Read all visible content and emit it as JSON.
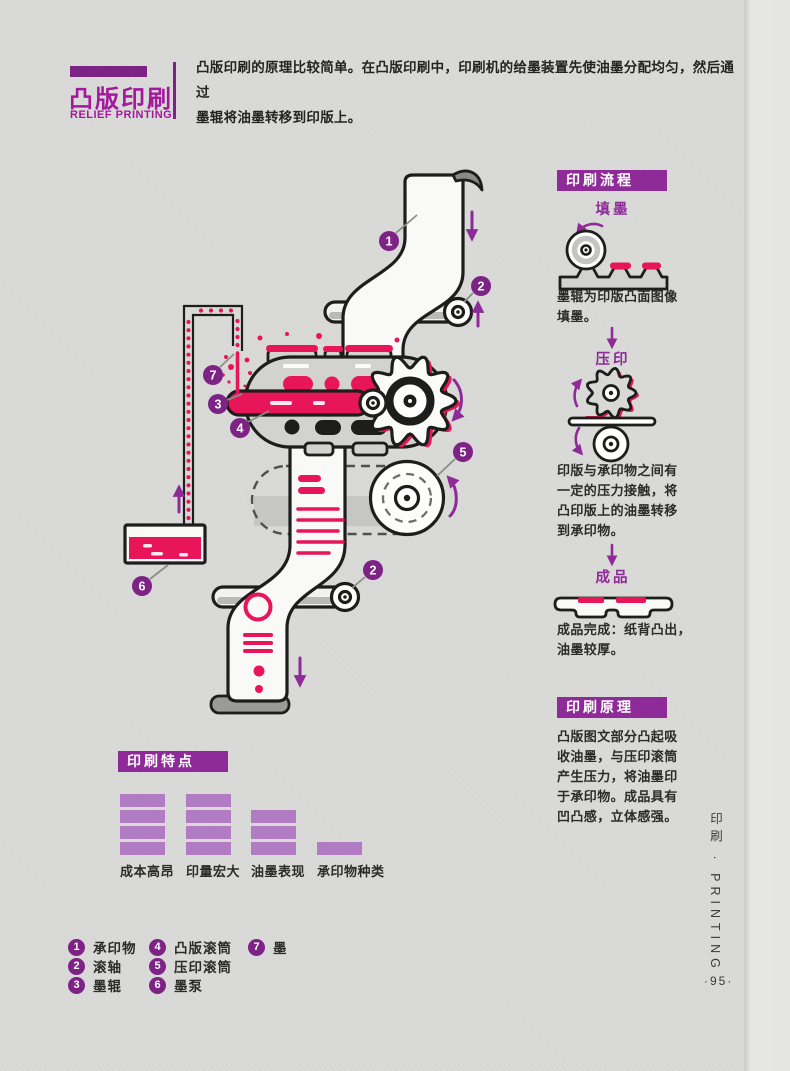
{
  "header": {
    "title": "凸版印刷",
    "subtitle": "RELIEF PRINTING",
    "intro": "凸版印刷的原理比较简单。在凸版印刷中，印刷机的给墨装置先使油墨分配均匀，然后通过\n墨辊将油墨转移到印版上。"
  },
  "process": {
    "heading": "印刷流程",
    "steps": [
      {
        "label": "填墨",
        "caption": "墨辊为印版凸面图像\n填墨。"
      },
      {
        "label": "压印",
        "caption": "印版与承印物之间有\n一定的压力接触，将\n凸印版上的油墨转移\n到承印物。"
      },
      {
        "label": "成品",
        "caption": "成品完成：纸背凸出，\n油墨较厚。"
      }
    ]
  },
  "principle": {
    "heading": "印刷原理",
    "body": "凸版图文部分凸起吸\n收油墨，与压印滚筒\n产生压力，将油墨印\n于承印物。成品具有\n凹凸感，立体感强。"
  },
  "features": {
    "heading": "印刷特点",
    "type": "bar",
    "categories": [
      "成本高昂",
      "印量宏大",
      "油墨表现",
      "承印物种类"
    ],
    "values": [
      4,
      4,
      3,
      1
    ],
    "max": 4
  },
  "legend": {
    "items": [
      {
        "num": "1",
        "label": "承印物"
      },
      {
        "num": "2",
        "label": "滚轴"
      },
      {
        "num": "3",
        "label": "墨辊"
      },
      {
        "num": "4",
        "label": "凸版滚筒"
      },
      {
        "num": "5",
        "label": "压印滚筒"
      },
      {
        "num": "6",
        "label": "墨泵"
      },
      {
        "num": "7",
        "label": "墨"
      }
    ]
  },
  "diagram": {
    "badge_placements": [
      "1",
      "2",
      "3",
      "4",
      "5",
      "6",
      "7",
      "2"
    ]
  },
  "side": {
    "label": "印刷 · PRINTING",
    "page_number": "·95·"
  },
  "colors": {
    "purple": "#8e2b98",
    "purple_dark": "#7d2386",
    "magenta": "#a3189d",
    "red": "#e8155a",
    "bar": "#b27cc4",
    "ink": "#1d1d1b"
  }
}
